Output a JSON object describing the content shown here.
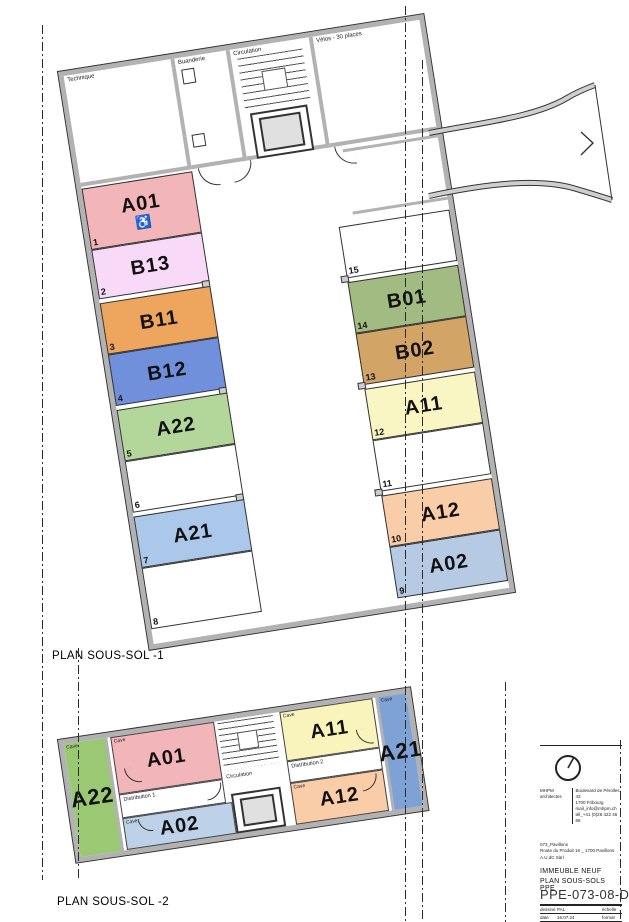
{
  "labels": {
    "plan1": "PLAN SOUS-SOL -1",
    "plan2": "PLAN SOUS-SOL -2"
  },
  "upper_plan": {
    "rooms": {
      "technique": "Technique",
      "buanderie": "Buanderie",
      "circulation": "Circulation",
      "velos": "Vélos - 30 places",
      "garage": "Garage"
    },
    "accessible_icon": "♿",
    "stalls_left": [
      {
        "num": "1",
        "label": "A01",
        "color": "#F2B5B9"
      },
      {
        "num": "2",
        "label": "B13",
        "color": "#F8DAF8"
      },
      {
        "num": "3",
        "label": "B11",
        "color": "#EEA55E"
      },
      {
        "num": "4",
        "label": "B12",
        "color": "#7090DB"
      },
      {
        "num": "5",
        "label": "A22",
        "color": "#B3D79B"
      },
      {
        "num": "6",
        "label": "",
        "color": "#FFFFFF"
      },
      {
        "num": "7",
        "label": "A21",
        "color": "#ABC7E9"
      },
      {
        "num": "8",
        "label": "",
        "color": "#FFFFFF"
      }
    ],
    "stalls_right": [
      {
        "num": "15",
        "label": "",
        "color": "#FFFFFF"
      },
      {
        "num": "14",
        "label": "B01",
        "color": "#A2BB83"
      },
      {
        "num": "13",
        "label": "B02",
        "color": "#D2A466"
      },
      {
        "num": "12",
        "label": "A11",
        "color": "#FAF6C3"
      },
      {
        "num": "11",
        "label": "",
        "color": "#FFFFFF"
      },
      {
        "num": "10",
        "label": "A12",
        "color": "#F8CDA7"
      },
      {
        "num": "9",
        "label": "A02",
        "color": "#B6CBE3"
      }
    ]
  },
  "lower_plan": {
    "cave_label": "Cave",
    "corridor1": "Distribution 1",
    "corridor2": "Distribution 2",
    "circulation": "Circulation",
    "rooms": [
      {
        "label": "A22",
        "color": "#9BC873"
      },
      {
        "label": "A01",
        "color": "#F2B5B9"
      },
      {
        "label": "A02",
        "color": "#BDD1E9"
      },
      {
        "label": "A11",
        "color": "#F8F4BC"
      },
      {
        "label": "A12",
        "color": "#F8CDA7"
      },
      {
        "label": "A21",
        "color": "#7FA2D6"
      }
    ]
  },
  "title_block": {
    "firm": "MHPM architectes",
    "address": [
      "Boulevard de Pérolles 43",
      "1700 Fribourg",
      "mail_info@mhpm.ch",
      "tél_+41 (0)26 422 46 65"
    ],
    "project": [
      "073_Pavillons",
      "Route du Produit 16 _ 1700 Pavillons",
      "A.U.dC Sàrl"
    ],
    "building": "IMMEUBLE NEUF",
    "drawing": "PLAN SOUS-SOLS PPE",
    "doc_number": "PPE-073-08-D",
    "meta": [
      {
        "k": "dessiné",
        "v": "PAL",
        "k2": "échelle",
        "v2": ""
      },
      {
        "k": "date",
        "v": "16.07.24",
        "k2": "format",
        "v2": ""
      },
      {
        "k": "amendt",
        "v": "+réseau",
        "k2": "",
        "v2": "Schéma PPE"
      }
    ]
  }
}
